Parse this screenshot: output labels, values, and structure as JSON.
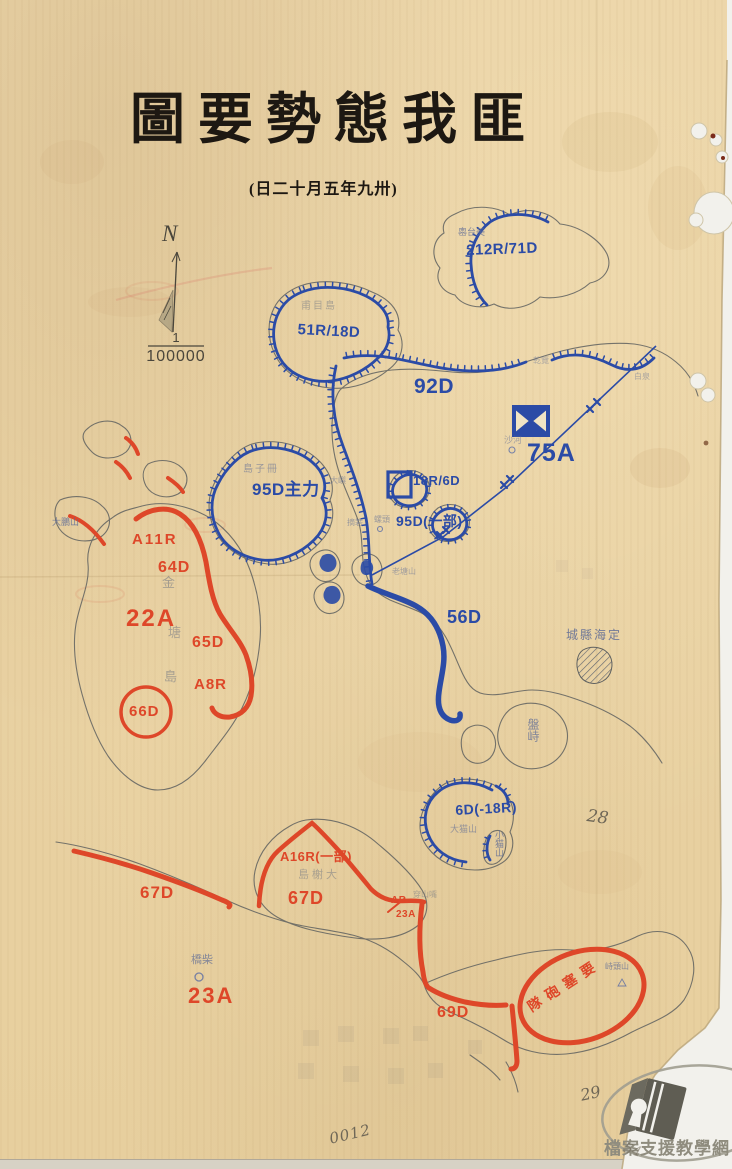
{
  "page": {
    "title": "圖要勢態我匪",
    "date_note": "(日二十月五年九卅)",
    "compass": {
      "north_label": "N"
    },
    "scale": {
      "numerator": "1",
      "denominator": "100000"
    }
  },
  "forces": {
    "friendly_blue": [
      {
        "label": "212R/71D"
      },
      {
        "label": "51R/18D"
      },
      {
        "label": "92D"
      },
      {
        "label": "75A"
      },
      {
        "label": "18R/6D"
      },
      {
        "label": "95D主力"
      },
      {
        "label": "95D(一部)"
      },
      {
        "label": "56D"
      },
      {
        "label": "6D(-18R)"
      }
    ],
    "enemy_red": [
      {
        "label": "A11R"
      },
      {
        "label": "64D"
      },
      {
        "label": "22A"
      },
      {
        "label": "65D"
      },
      {
        "label": "A8R"
      },
      {
        "label": "66D"
      },
      {
        "label": "67D"
      },
      {
        "label": "A16R(一部)"
      },
      {
        "label": "67D"
      },
      {
        "label": "AR"
      },
      {
        "label": "23A"
      },
      {
        "label": "23A"
      },
      {
        "label": "69D"
      },
      {
        "label": "隊砲塞要"
      }
    ]
  },
  "places": [
    {
      "label": "嶴台美"
    },
    {
      "label": "甫目島"
    },
    {
      "label": "島子冊"
    },
    {
      "label": "金"
    },
    {
      "label": "塘"
    },
    {
      "label": "島"
    },
    {
      "label": "城縣海定"
    },
    {
      "label": "盤峙"
    },
    {
      "label": "大猫山"
    },
    {
      "label": "小猫山"
    },
    {
      "label": "島榭大"
    },
    {
      "label": "橋柴"
    },
    {
      "label": "峙頭山"
    },
    {
      "label": "大鵬山"
    },
    {
      "label": "沙河"
    },
    {
      "label": "白泉"
    },
    {
      "label": "乾覽"
    },
    {
      "label": "老塘山"
    },
    {
      "label": "螺頭"
    },
    {
      "label": "大嶼"
    },
    {
      "label": "摘箬"
    },
    {
      "label": "穿山嘴"
    }
  ],
  "annotations": {
    "page_number_upper": "28",
    "page_number_lower": "29",
    "doc_number": "0012",
    "pencil_mark": "54"
  },
  "watermark": {
    "site_name": "檔案支援教學網"
  },
  "colors": {
    "paper": "#e9d2a4",
    "friendly_blue": "#2b4ba6",
    "enemy_red": "#de4729",
    "ink_black": "#1d1812",
    "coastline": "#5f6160",
    "pencil": "#6f6757",
    "watermark_gray": "#8f8c7e"
  }
}
